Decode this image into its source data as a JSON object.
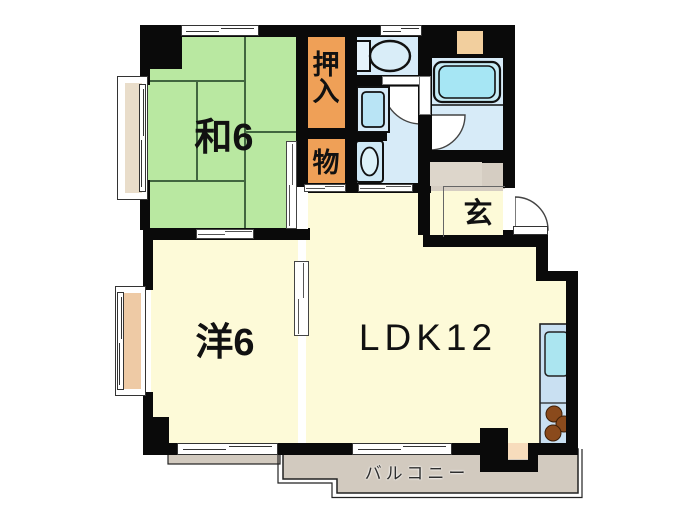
{
  "title": "apartment-floor-plan",
  "rooms": {
    "japanese_room": {
      "label": "和6",
      "type": "tatami-room",
      "size_mats": 6
    },
    "closet_oshiire": {
      "label": "押入",
      "type": "futon-closet"
    },
    "closet_storage": {
      "label": "物",
      "type": "storage-closet"
    },
    "entrance": {
      "label": "玄",
      "type": "genkan"
    },
    "western_room": {
      "label": "洋6",
      "type": "western-room",
      "size_mats": 6
    },
    "ldk": {
      "label": "LDK12",
      "type": "living-dining-kitchen",
      "size_mats": 12
    },
    "balcony": {
      "label": "バルコニー",
      "type": "balcony"
    }
  },
  "fixtures": [
    "toilet",
    "washing-machine-pan",
    "washbasin",
    "bathtub",
    "kitchen-sink",
    "stove-burners",
    "entrance-door",
    "bay-windows"
  ],
  "colors": {
    "wall": "#0a0a0a",
    "tatami_room": "#b9e8a1",
    "tatami_line": "#41663f",
    "cream_room": "#fdfad8",
    "wet_area": "#d7ebf8",
    "closet": "#efa057",
    "entrance_balcony": "#d2cabf",
    "bath_water": "#a6e6f4",
    "kitchen_counter": "#c9e0f2",
    "burner": "#8a4a1c",
    "bay_sill_north": "#e9ddca",
    "bay_sill_west": "#eecaa5",
    "service_square": "#f2cf9e"
  }
}
